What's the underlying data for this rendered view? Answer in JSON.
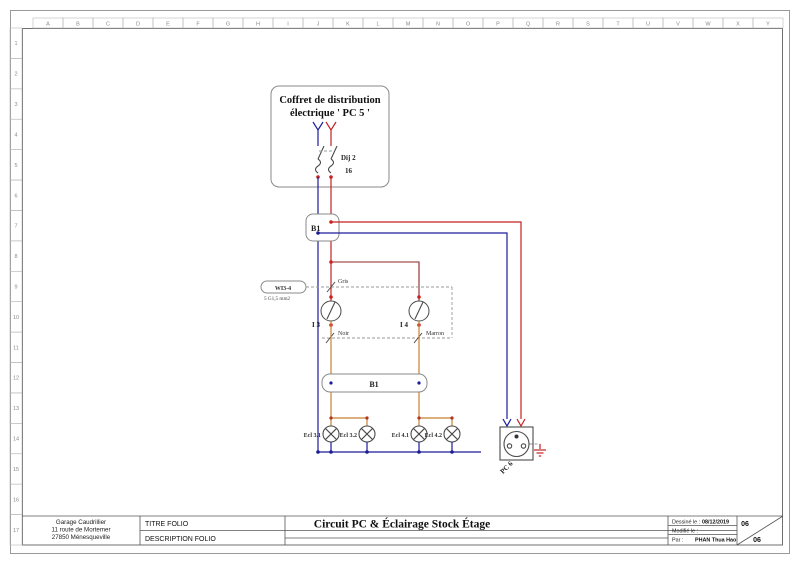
{
  "page": {
    "grid_columns": [
      "A",
      "B",
      "C",
      "D",
      "E",
      "F",
      "G",
      "H",
      "I",
      "J",
      "K",
      "L",
      "M",
      "N",
      "O",
      "P",
      "Q",
      "R",
      "S",
      "T",
      "U",
      "V",
      "W",
      "X",
      "Y"
    ],
    "grid_rows": [
      "1",
      "2",
      "3",
      "4",
      "5",
      "6",
      "7",
      "8",
      "9",
      "10",
      "11",
      "12",
      "13",
      "14",
      "15",
      "16",
      "17"
    ]
  },
  "schematic": {
    "distribution_box": {
      "title_line1": "Coffret de distribution",
      "title_line2": "électrique ' PC 5 '"
    },
    "breaker": {
      "name": "Dij 2",
      "rating": "16"
    },
    "junction_top": {
      "label": "B1"
    },
    "junction_bottom": {
      "label": "B1"
    },
    "cable": {
      "name": "WI3-4",
      "spec": "5 G1,5 mm2"
    },
    "wire_marks": {
      "gris": "Gris",
      "noir": "Noir",
      "marron": "Marron"
    },
    "switches": [
      {
        "label": "I 3"
      },
      {
        "label": "I 4"
      }
    ],
    "lamps": [
      {
        "label": "Ecl 3.1"
      },
      {
        "label": "Ecl 3.2"
      },
      {
        "label": "Ecl 4.1"
      },
      {
        "label": "Ecl 4.2"
      }
    ],
    "socket": {
      "label": "PC 6"
    }
  },
  "titleblock": {
    "company": [
      "Garage Caudrillier",
      "11 route de Mortemer",
      "27850 Ménesqueville"
    ],
    "titre_label": "TITRE FOLIO",
    "description_label": "DESCRIPTION FOLIO",
    "title": "Circuit PC & Éclairage Stock Étage",
    "drawn_label": "Dessiné le :",
    "drawn_date": "08/12/2019",
    "modified_label": "Modifié le :",
    "by_label": "Par :",
    "author": "PHAN Thua Hao",
    "folio_current": "06",
    "folio_total": "06"
  },
  "colors": {
    "neutral_blue": "#1c1c99",
    "phase_red": "#c32222",
    "phase_dark_red": "#8e2323",
    "switched_orange": "#c8812e",
    "cable_dash_gray": "#9a9a9a",
    "terminal_dot_red": "#cc2222",
    "symbol_gray": "#4a4a4a"
  }
}
